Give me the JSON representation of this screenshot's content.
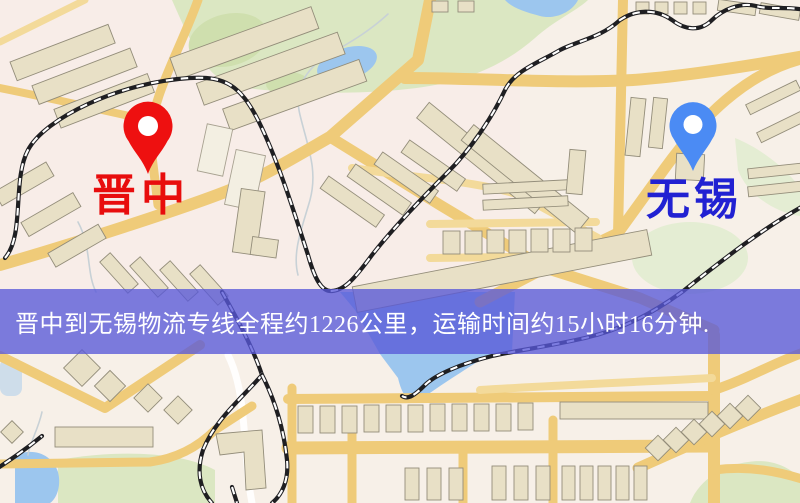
{
  "map": {
    "origin": {
      "name": "晋中",
      "pin_color": "#ee1010",
      "label_color": "#e80d0d"
    },
    "destination": {
      "name": "无锡",
      "pin_color": "#4b8bf4",
      "label_color": "#2121d2"
    },
    "banner": {
      "text": "晋中到无锡物流专线全程约1226公里，运输时间约15小时16分钟.",
      "background": "rgba(88,88,216,0.78)",
      "text_color": "#ffffff",
      "distance_km": "1226",
      "duration": "15小时16分钟"
    }
  }
}
